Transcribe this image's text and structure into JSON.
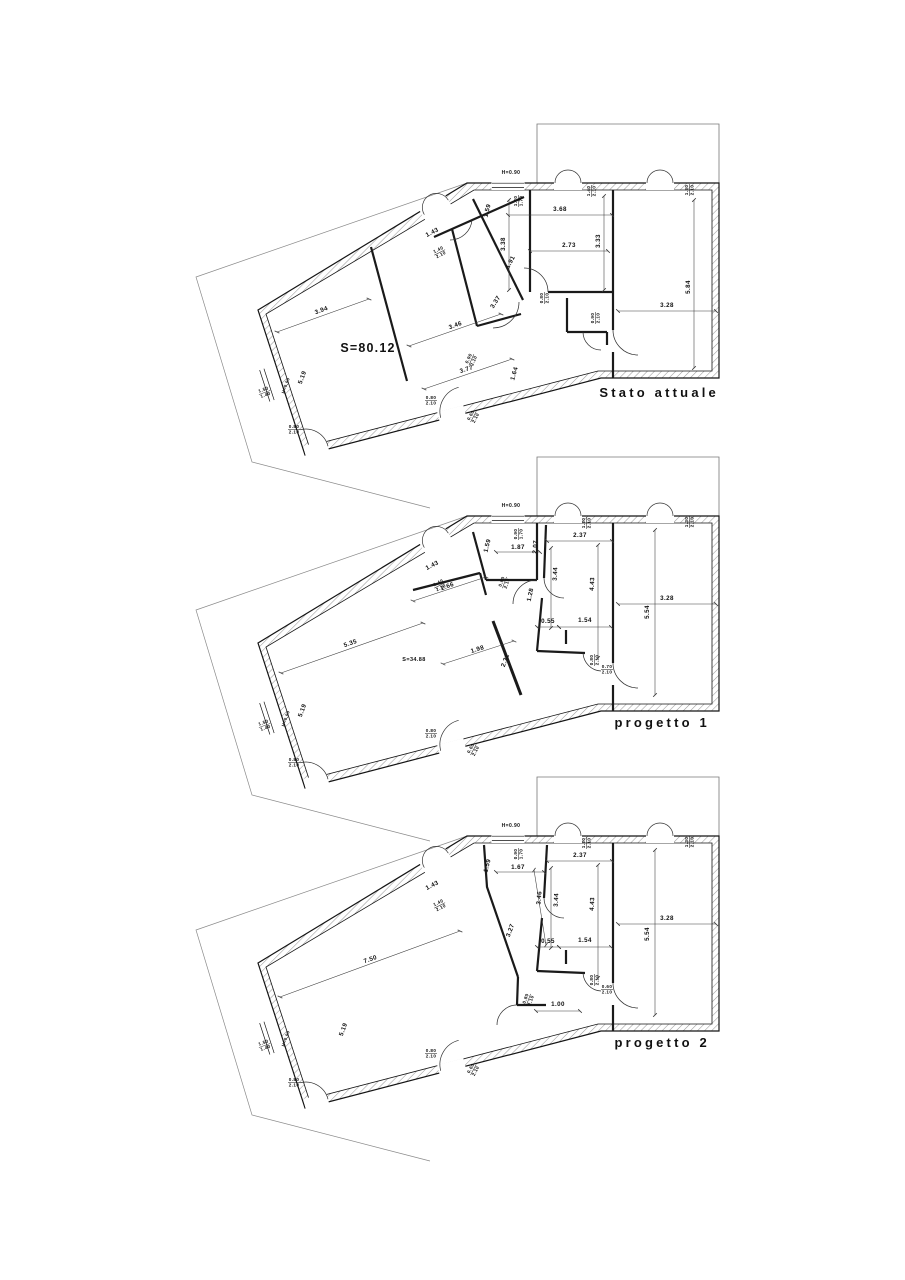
{
  "document": {
    "type": "floor-plan-sheet",
    "background": "#ffffff",
    "wall_line_color": "#141414",
    "hatch_color": "#9a9a9a",
    "dim_line_color": "#3a3a3a",
    "lot_line_color": "#8a8a8a"
  },
  "plans": [
    {
      "id": "stato-attuale",
      "title": "Stato attuale",
      "area_label": "S=80.12",
      "labels": [
        {
          "t": "H=0.90",
          "x": 511,
          "y": 174,
          "s": 5
        },
        {
          "t": "1.20/1.70",
          "x": 517,
          "y": 201,
          "r": -90
        },
        {
          "t": "1.40/2.10",
          "x": 590,
          "y": 191,
          "r": -90
        },
        {
          "t": "1.30/2.10",
          "x": 688,
          "y": 190,
          "r": -90
        },
        {
          "t": "1.59",
          "x": 489,
          "y": 211,
          "r": -76
        },
        {
          "t": "3.68",
          "x": 560,
          "y": 211,
          "line": [
            508,
            215,
            612,
            215
          ]
        },
        {
          "t": "3.38",
          "x": 505,
          "y": 244,
          "r": -90,
          "line": [
            509,
            200,
            509,
            290
          ]
        },
        {
          "t": "3.33",
          "x": 600,
          "y": 241,
          "r": -90,
          "line": [
            604,
            196,
            604,
            290
          ]
        },
        {
          "t": "2.73",
          "x": 569,
          "y": 247,
          "line": [
            530,
            251,
            608,
            251
          ]
        },
        {
          "t": "1.91",
          "x": 512,
          "y": 263,
          "r": -62
        },
        {
          "t": "3.37",
          "x": 497,
          "y": 303,
          "r": -58
        },
        {
          "t": "5.84",
          "x": 690,
          "y": 287,
          "r": -90,
          "line": [
            694,
            200,
            694,
            368
          ]
        },
        {
          "t": "3.28",
          "x": 667,
          "y": 307,
          "line": [
            618,
            311,
            716,
            311
          ]
        },
        {
          "t": "1.43",
          "x": 433,
          "y": 234,
          "r": -27
        },
        {
          "t": "1.40/2.10",
          "x": 439,
          "y": 251,
          "r": -27
        },
        {
          "t": "3.94",
          "x": 322,
          "y": 312,
          "r": -20,
          "line": [
            277,
            332,
            369,
            299
          ]
        },
        {
          "t": "S=80.12",
          "x": 368,
          "y": 352,
          "s": 12.5
        },
        {
          "t": "3.46",
          "x": 456,
          "y": 327,
          "r": -20,
          "line": [
            409,
            346,
            501,
            314
          ]
        },
        {
          "t": "3.77",
          "x": 467,
          "y": 371,
          "r": -18,
          "line": [
            424,
            389,
            512,
            359
          ]
        },
        {
          "t": "1.64",
          "x": 516,
          "y": 374,
          "r": -74
        },
        {
          "t": "5.19",
          "x": 304,
          "y": 378,
          "r": -70
        },
        {
          "t": "0.80/2.10",
          "x": 543,
          "y": 298,
          "r": -90
        },
        {
          "t": "0.90/2.10",
          "x": 594,
          "y": 318,
          "r": -90
        },
        {
          "t": "0.90/2.10",
          "x": 470,
          "y": 359,
          "r": -66
        },
        {
          "t": "1.50/1.40",
          "x": 264,
          "y": 391,
          "r": -20
        },
        {
          "t": "H=0.90",
          "x": 287,
          "y": 386,
          "r": -70,
          "s": 4.3
        },
        {
          "t": "0.80/2.10",
          "x": 294,
          "y": 428
        },
        {
          "t": "0.80/2.10",
          "x": 431,
          "y": 399
        },
        {
          "t": "0.60/2.10",
          "x": 472,
          "y": 416,
          "r": -62
        }
      ]
    },
    {
      "id": "progetto-1",
      "title": "progetto 1",
      "area_label": "S=34.88",
      "labels": [
        {
          "t": "H=0.90",
          "x": 511,
          "y": 507,
          "s": 5
        },
        {
          "t": "0.90/1.70",
          "x": 517,
          "y": 534,
          "r": -90
        },
        {
          "t": "1.20/2.10",
          "x": 585,
          "y": 523,
          "r": -90
        },
        {
          "t": "1.30/2.10",
          "x": 688,
          "y": 522,
          "r": -90
        },
        {
          "t": "1.59",
          "x": 489,
          "y": 546,
          "r": -76
        },
        {
          "t": "1.87",
          "x": 518,
          "y": 549,
          "line": [
            496,
            552,
            540,
            552
          ]
        },
        {
          "t": "2.07",
          "x": 537,
          "y": 547,
          "r": -86
        },
        {
          "t": "2.37",
          "x": 580,
          "y": 537,
          "line": [
            547,
            541,
            612,
            541
          ]
        },
        {
          "t": "3.44",
          "x": 557,
          "y": 574,
          "r": -87,
          "line": [
            551,
            548,
            551,
            628
          ]
        },
        {
          "t": "4.43",
          "x": 594,
          "y": 584,
          "r": -87,
          "line": [
            598,
            545,
            598,
            658
          ]
        },
        {
          "t": "1.28",
          "x": 532,
          "y": 595,
          "r": -78
        },
        {
          "t": "0.80/2.10",
          "x": 503,
          "y": 582,
          "r": -70
        },
        {
          "t": "1.43",
          "x": 433,
          "y": 567,
          "r": -27
        },
        {
          "t": "1.40/2.10",
          "x": 439,
          "y": 584,
          "r": -27
        },
        {
          "t": "2.66",
          "x": 448,
          "y": 588,
          "r": -20,
          "line": [
            413,
            601,
            486,
            577
          ]
        },
        {
          "t": "1.98",
          "x": 478,
          "y": 651,
          "r": -18,
          "line": [
            443,
            664,
            514,
            641
          ]
        },
        {
          "t": "2.31",
          "x": 507,
          "y": 661,
          "r": -70
        },
        {
          "t": "5.35",
          "x": 351,
          "y": 645,
          "r": -19,
          "line": [
            281,
            673,
            423,
            623
          ]
        },
        {
          "t": "S=34.88",
          "x": 414,
          "y": 661,
          "s": 5.5
        },
        {
          "t": "0.55",
          "x": 548,
          "y": 623,
          "line": [
            537,
            627,
            559,
            627
          ]
        },
        {
          "t": "1.54",
          "x": 585,
          "y": 622,
          "line": [
            559,
            627,
            611,
            627
          ]
        },
        {
          "t": "5.54",
          "x": 649,
          "y": 612,
          "r": -90,
          "line": [
            655,
            530,
            655,
            695
          ]
        },
        {
          "t": "3.28",
          "x": 667,
          "y": 600,
          "line": [
            618,
            604,
            716,
            604
          ]
        },
        {
          "t": "0.80/2.10",
          "x": 593,
          "y": 660,
          "r": -90
        },
        {
          "t": "0.70/2.10",
          "x": 607,
          "y": 668
        },
        {
          "t": "5.19",
          "x": 304,
          "y": 711,
          "r": -70
        },
        {
          "t": "1.50/1.40",
          "x": 264,
          "y": 724,
          "r": -20
        },
        {
          "t": "H=0.90",
          "x": 287,
          "y": 719,
          "r": -70,
          "s": 4.3
        },
        {
          "t": "0.80/2.10",
          "x": 294,
          "y": 761
        },
        {
          "t": "0.80/2.10",
          "x": 431,
          "y": 732
        },
        {
          "t": "0.60/2.10",
          "x": 472,
          "y": 749,
          "r": -62
        }
      ]
    },
    {
      "id": "progetto-2",
      "title": "progetto 2",
      "area_label": "",
      "labels": [
        {
          "t": "H=0.90",
          "x": 511,
          "y": 827,
          "s": 5
        },
        {
          "t": "0.90/1.70",
          "x": 517,
          "y": 854,
          "r": -90
        },
        {
          "t": "1.20/2.10",
          "x": 585,
          "y": 843,
          "r": -90
        },
        {
          "t": "1.30/2.10",
          "x": 688,
          "y": 842,
          "r": -90
        },
        {
          "t": "1.59",
          "x": 489,
          "y": 866,
          "r": -76
        },
        {
          "t": "1.67",
          "x": 518,
          "y": 869,
          "line": [
            496,
            872,
            544,
            872
          ]
        },
        {
          "t": "2.37",
          "x": 580,
          "y": 857,
          "line": [
            547,
            861,
            612,
            861
          ]
        },
        {
          "t": "3.46",
          "x": 541,
          "y": 898,
          "r": -85,
          "line": [
            534,
            870,
            546,
            945
          ]
        },
        {
          "t": "3.44",
          "x": 558,
          "y": 900,
          "r": -87,
          "line": [
            551,
            868,
            551,
            948
          ]
        },
        {
          "t": "4.43",
          "x": 594,
          "y": 904,
          "r": -87,
          "line": [
            598,
            865,
            598,
            978
          ]
        },
        {
          "t": "3.27",
          "x": 512,
          "y": 931,
          "r": -70
        },
        {
          "t": "1.43",
          "x": 433,
          "y": 887,
          "r": -27
        },
        {
          "t": "1.40/2.10",
          "x": 439,
          "y": 904,
          "r": -27
        },
        {
          "t": "7.50",
          "x": 371,
          "y": 961,
          "r": -19,
          "line": [
            280,
            997,
            460,
            931
          ]
        },
        {
          "t": "0.55",
          "x": 548,
          "y": 943,
          "line": [
            537,
            947,
            559,
            947
          ]
        },
        {
          "t": "1.54",
          "x": 585,
          "y": 942,
          "line": [
            559,
            947,
            611,
            947
          ]
        },
        {
          "t": "1.00",
          "x": 558,
          "y": 1006,
          "line": [
            536,
            1011,
            580,
            1011
          ]
        },
        {
          "t": "0.80/2.10",
          "x": 527,
          "y": 999,
          "r": -70
        },
        {
          "t": "5.54",
          "x": 649,
          "y": 934,
          "r": -90,
          "line": [
            655,
            850,
            655,
            1015
          ]
        },
        {
          "t": "3.28",
          "x": 667,
          "y": 920,
          "line": [
            618,
            924,
            716,
            924
          ]
        },
        {
          "t": "0.80/2.10",
          "x": 593,
          "y": 980,
          "r": -90
        },
        {
          "t": "0.60/2.10",
          "x": 607,
          "y": 988
        },
        {
          "t": "5.19",
          "x": 345,
          "y": 1030,
          "r": -70
        },
        {
          "t": "1.50/1.40",
          "x": 264,
          "y": 1044,
          "r": -20
        },
        {
          "t": "H=0.90",
          "x": 287,
          "y": 1039,
          "r": -70,
          "s": 4.3
        },
        {
          "t": "0.80/2.10",
          "x": 294,
          "y": 1081
        },
        {
          "t": "0.80/2.10",
          "x": 431,
          "y": 1052
        },
        {
          "t": "0.60/2.10",
          "x": 472,
          "y": 1069,
          "r": -62
        }
      ]
    }
  ]
}
